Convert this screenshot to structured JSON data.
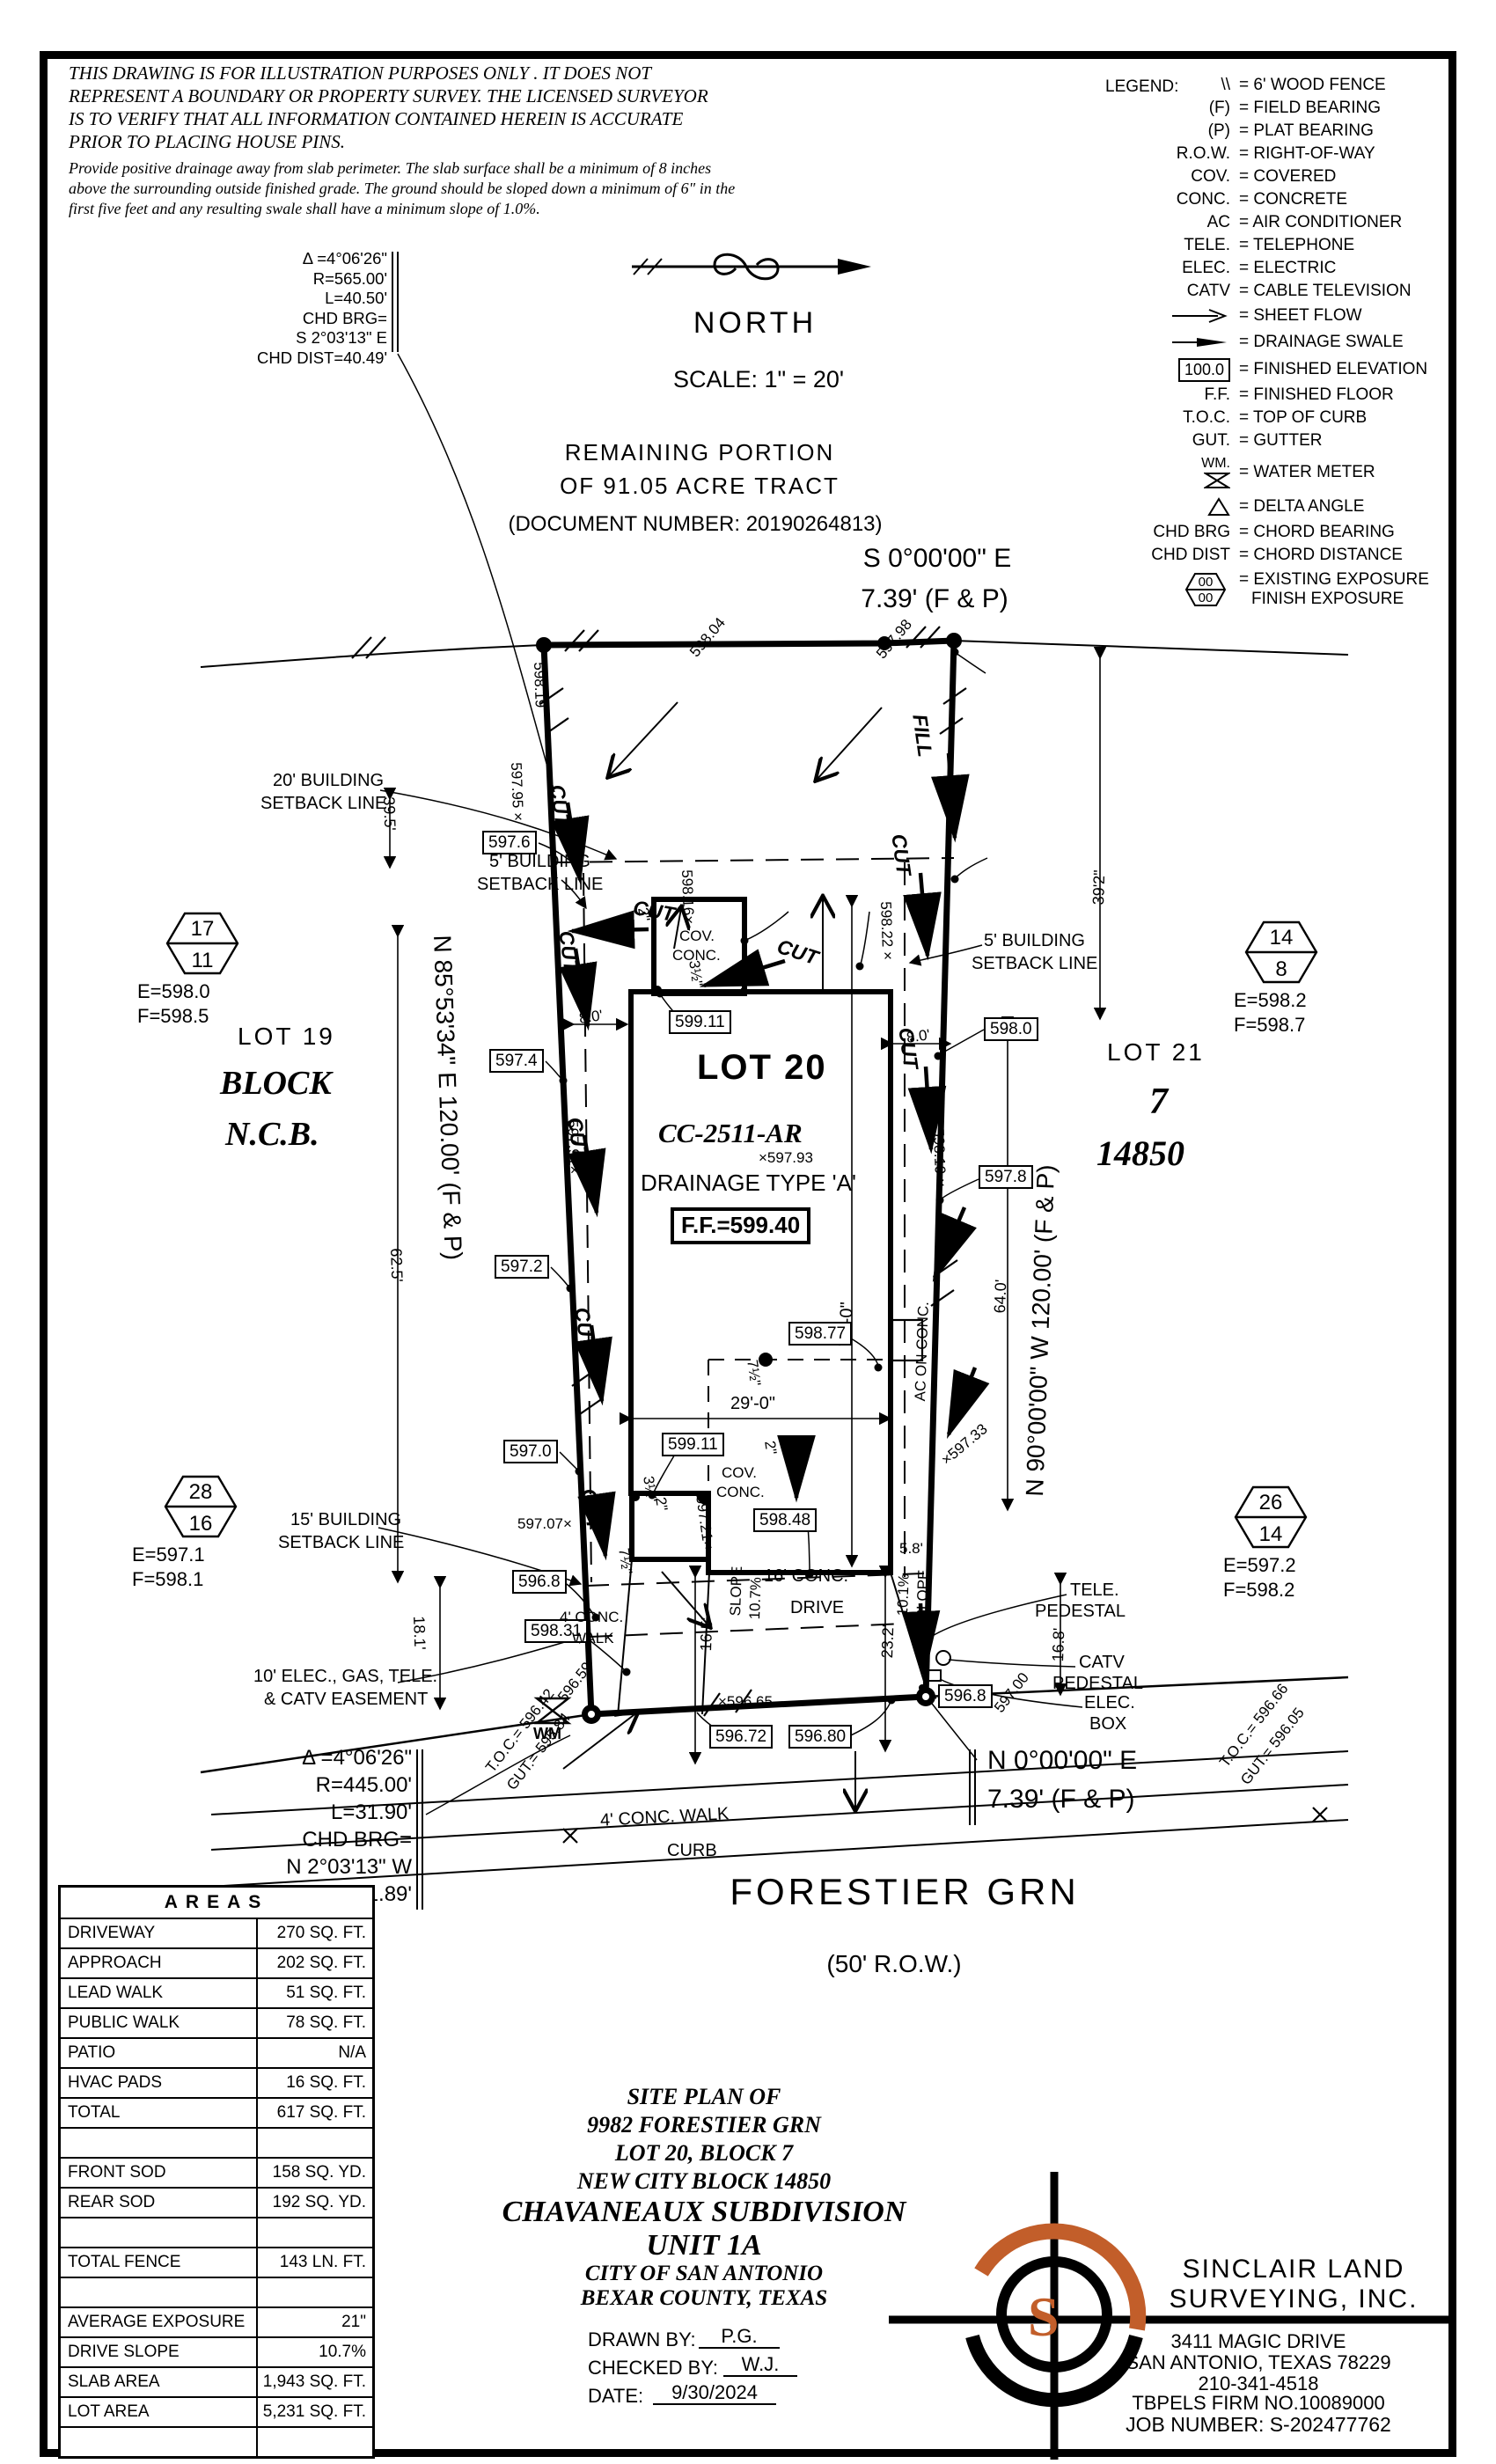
{
  "disclaimer": {
    "p1": "THIS DRAWING IS FOR ILLUSTRATION PURPOSES ONLY . IT DOES NOT REPRESENT A BOUNDARY OR PROPERTY SURVEY. THE LICENSED SURVEYOR IS TO VERIFY THAT ALL INFORMATION CONTAINED HEREIN IS ACCURATE PRIOR TO PLACING HOUSE PINS.",
    "p2": "Provide positive drainage away from slab perimeter. The slab surface shall be a minimum of 8 inches above the surrounding outside finished grade. The ground should be sloped down a minimum of 6\" in the first five feet and any resulting swale shall have a minimum slope of 1.0%."
  },
  "north": {
    "label": "NORTH",
    "scale": "SCALE: 1\" = 20'"
  },
  "legend": {
    "title": "LEGEND:",
    "wm_label": "WM.",
    "exp1": "00",
    "exp2": "00",
    "rows": [
      {
        "sym": "\\\\",
        "desc": "=  6' WOOD FENCE"
      },
      {
        "sym": "(F)",
        "desc": "=  FIELD BEARING"
      },
      {
        "sym": "(P)",
        "desc": "=  PLAT BEARING"
      },
      {
        "sym": "R.O.W.",
        "desc": "=  RIGHT-OF-WAY"
      },
      {
        "sym": "COV.",
        "desc": "=  COVERED"
      },
      {
        "sym": "CONC.",
        "desc": "=  CONCRETE"
      },
      {
        "sym": "AC",
        "desc": "=  AIR CONDITIONER"
      },
      {
        "sym": "TELE.",
        "desc": "=  TELEPHONE"
      },
      {
        "sym": "ELEC.",
        "desc": "=  ELECTRIC"
      },
      {
        "sym": "CATV",
        "desc": "=  CABLE TELEVISION"
      },
      {
        "sym": "",
        "desc": "=  SHEET FLOW"
      },
      {
        "sym": "",
        "desc": "=  DRAINAGE SWALE"
      },
      {
        "sym": "100.0",
        "desc": "=  FINISHED ELEVATION"
      },
      {
        "sym": "F.F.",
        "desc": "=  FINISHED FLOOR"
      },
      {
        "sym": "T.O.C.",
        "desc": "=  TOP OF CURB"
      },
      {
        "sym": "GUT.",
        "desc": "=  GUTTER"
      },
      {
        "sym": "",
        "desc": "=  WATER METER"
      },
      {
        "sym": "",
        "desc": "=  DELTA ANGLE"
      },
      {
        "sym": "CHD BRG",
        "desc": "=  CHORD BEARING"
      },
      {
        "sym": "CHD DIST",
        "desc": "=  CHORD DISTANCE"
      },
      {
        "sym": "",
        "desc": "=  EXISTING EXPOSURE",
        "desc2": "FINISH EXPOSURE"
      }
    ]
  },
  "curve_top": {
    "l1": "Δ =4°06'26\"",
    "l2": "R=565.00'",
    "l3": "L=40.50'",
    "l4": "CHD BRG=",
    "l5": "S 2°03'13\" E",
    "l6": "CHD DIST=40.49'"
  },
  "curve_bot": {
    "l1": "Δ =4°06'26\"",
    "l2": "R=445.00'",
    "l3": "L=31.90'",
    "l4": "CHD BRG=",
    "l5": "N 2°03'13\" W",
    "l6": "CHD DIST=31.89'"
  },
  "tract": {
    "l1": "REMAINING PORTION",
    "l2": "OF 91.05 ACRE TRACT",
    "l3": "(DOCUMENT NUMBER: 20190264813)"
  },
  "bearings": {
    "top1": "S 0°00'00\" E",
    "top2": "7.39' (F & P)",
    "west": "N 85°53'34\" E 120.00' (F & P)",
    "east": "N 90°00'00\" W 120.00' (F & P)",
    "bot1": "N 0°00'00\" E",
    "bot2": "7.39' (F & P)"
  },
  "lots": {
    "lot19": "LOT 19",
    "block": "BLOCK",
    "ncb": "N.C.B.",
    "lot20": "LOT 20",
    "cc": "CC-2511-AR",
    "drain": "DRAINAGE TYPE 'A'",
    "ff": "F.F.=599.40",
    "lot21": "LOT 21",
    "seven": "7",
    "ncb_num": "14850"
  },
  "hex": {
    "h1t": "17",
    "h1b": "11",
    "h1e": "E=598.0",
    "h1f": "F=598.5",
    "h2t": "14",
    "h2b": "8",
    "h2e": "E=598.2",
    "h2f": "F=598.7",
    "h3t": "28",
    "h3b": "16",
    "h3e": "E=597.1",
    "h3f": "F=598.1",
    "h4t": "26",
    "h4b": "14",
    "h4e": "E=597.2",
    "h4f": "F=598.2"
  },
  "setbacks": {
    "s20a": "20' BUILDING",
    "s20b": "SETBACK LINE",
    "s5a": "5' BUILDING",
    "s5b": "SETBACK LINE",
    "s15a": "15' BUILDING",
    "s15b": "SETBACK LINE",
    "easeA": "10' ELEC., GAS, TELE.",
    "easeB": "& CATV EASEMENT"
  },
  "grades": {
    "g1": "598.19",
    "g2": "598.04",
    "g3": "597.98",
    "g4": "597.95 ×",
    "g5": "598.16×",
    "g6": "598.22 ×",
    "g7": "597.91×",
    "g8": "598.19 ×",
    "g9": "×597.93",
    "g10": "597.21×",
    "g11": "×597.33",
    "g12": "597.07×",
    "g13": "596.59",
    "g14": "×596.65",
    "g15": "597.00"
  },
  "boxes": {
    "v5985": "598.5",
    "v5983": "598.3",
    "v5979": "597.9",
    "v5982": "598.2",
    "v5976": "597.6",
    "v5974": "597.4",
    "v5972": "597.2",
    "v5970": "597.0",
    "v5980": "598.0",
    "v5978": "597.8",
    "v59877": "598.77",
    "v59848": "598.48",
    "v59911": "599.11",
    "v5968": "596.8",
    "v59831": "598.31",
    "v59672": "596.72",
    "v59680": "596.80"
  },
  "flow": {
    "cut": "CUT",
    "fill": "FILL"
  },
  "dims": {
    "d80": "8.0'",
    "d290": "29'-0\"",
    "d2": "2\"",
    "d35": "3½\"",
    "d75": "7½\"",
    "d740": "74'-0\"",
    "d395": "39.5'",
    "d625": "62.5'",
    "d181": "18.1'",
    "d392": "39'2\"",
    "d640": "64.0'",
    "d168": "16.8'",
    "d232": "23.2'",
    "d165": "16.5'",
    "d58": "5.8'"
  },
  "site": {
    "cov1": "COV.",
    "cov2": "CONC.",
    "ac": "AC ON CONC.",
    "walk1": "4' CONC.",
    "walk2": "WALK",
    "walk_st": "4' CONC. WALK",
    "drive1": "16' CONC.",
    "drive2": "DRIVE",
    "slope": "SLOPE",
    "s107": "10.7%",
    "s101": "10.1%",
    "curb": "CURB",
    "wm": "WM",
    "tele1": "TELE.",
    "tele2": "PEDESTAL",
    "catv1": "CATV",
    "catv2": "PEDESTAL",
    "elec1": "ELEC.",
    "elec2": "BOX",
    "tocL1": "T.O.C.= 596.42",
    "tocL2": "GUT.= 595.84",
    "tocR1": "T.O.C.= 596.66",
    "tocR2": "GUT.= 596.05"
  },
  "street": {
    "name": "FORESTIER GRN",
    "row": "(50' R.O.W.)"
  },
  "areas": {
    "title": "AREAS",
    "rows": [
      {
        "label": "DRIVEWAY",
        "value": "270 SQ. FT."
      },
      {
        "label": "APPROACH",
        "value": "202 SQ. FT."
      },
      {
        "label": "LEAD WALK",
        "value": "51 SQ. FT."
      },
      {
        "label": "PUBLIC WALK",
        "value": "78 SQ. FT."
      },
      {
        "label": "PATIO",
        "value": "N/A"
      },
      {
        "label": "HVAC PADS",
        "value": "16 SQ. FT."
      },
      {
        "label": "TOTAL",
        "value": "617 SQ. FT."
      },
      {
        "label": "",
        "value": ""
      },
      {
        "label": "FRONT SOD",
        "value": "158 SQ. YD."
      },
      {
        "label": "REAR SOD",
        "value": "192 SQ. YD."
      },
      {
        "label": "",
        "value": ""
      },
      {
        "label": "TOTAL FENCE",
        "value": "143  LN. FT."
      },
      {
        "label": "",
        "value": ""
      },
      {
        "label": "AVERAGE EXPOSURE",
        "value": "21\""
      },
      {
        "label": "DRIVE SLOPE",
        "value": "10.7%"
      },
      {
        "label": "SLAB AREA",
        "value": "1,943 SQ. FT."
      },
      {
        "label": "LOT AREA",
        "value": "5,231 SQ. FT."
      },
      {
        "label": "",
        "value": ""
      }
    ]
  },
  "titleblock": {
    "t1": "SITE PLAN OF",
    "t2": "9982 FORESTIER GRN",
    "t3": "LOT 20, BLOCK 7",
    "t4": "NEW CITY BLOCK 14850",
    "t5": "CHAVANEAUX SUBDIVISION",
    "t6": "UNIT 1A",
    "t7": "CITY OF SAN ANTONIO",
    "t8": "BEXAR COUNTY, TEXAS",
    "drawn_label": "DRAWN BY:",
    "drawn": "P.G.",
    "checked_label": "CHECKED BY:",
    "checked": "W.J.",
    "date_label": "DATE:",
    "date": "9/30/2024"
  },
  "firm": {
    "logo_s": "S",
    "name1": "SINCLAIR LAND",
    "name2": "SURVEYING, INC.",
    "addr1": "3411 MAGIC DRIVE",
    "addr2": "SAN ANTONIO, TEXAS 78229",
    "phone": "210-341-4518",
    "firm_no": "TBPELS FIRM NO.10089000",
    "job": "JOB NUMBER: S-202477762"
  },
  "colors": {
    "accent": "#c25e2a",
    "ink": "#000000",
    "paper": "#ffffff"
  }
}
